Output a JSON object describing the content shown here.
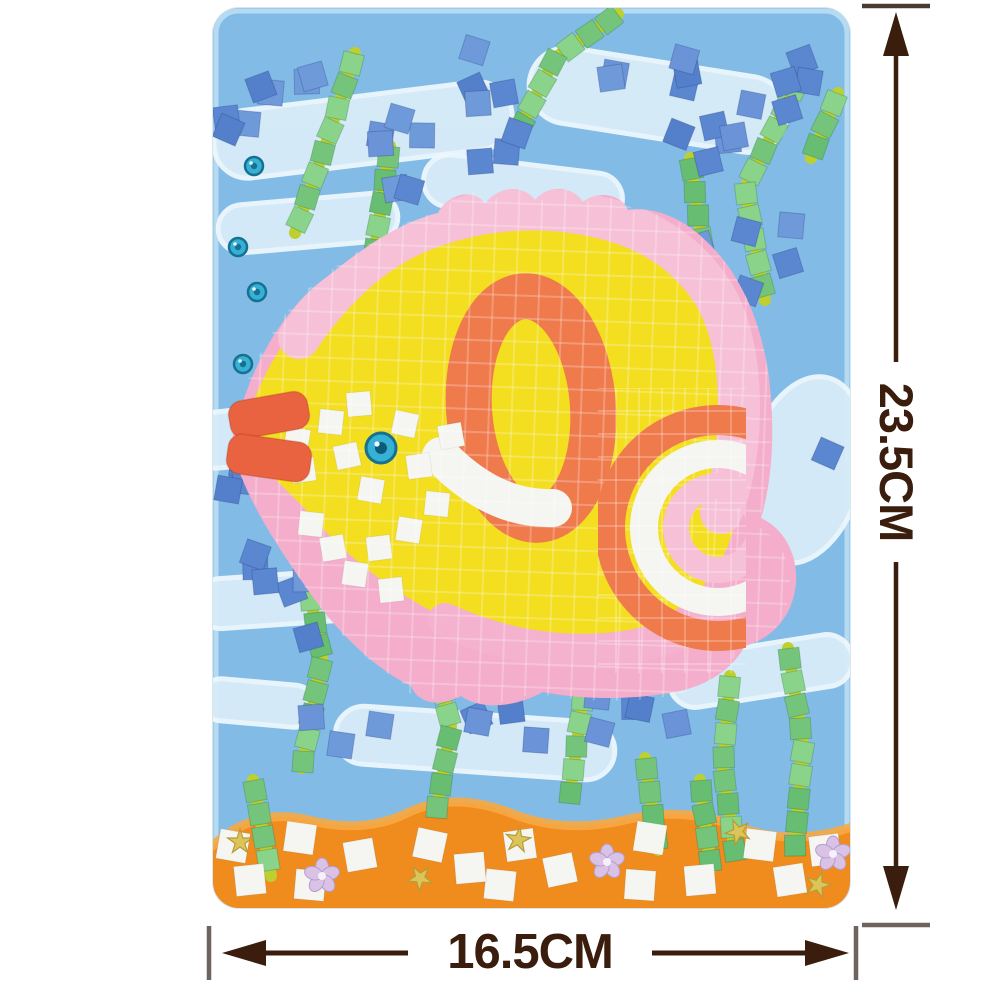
{
  "product": {
    "description": "Foam mosaic sticker craft kit picture of a tropical fish under water",
    "subject": "mosaic-fish-craft-board"
  },
  "dims": {
    "arrow_color": "#3a1d0d",
    "cap_color": "#6e645d",
    "height": {
      "label": "23.5CM",
      "x": 896,
      "cap_top_y": 6,
      "cap_bottom_y": 925,
      "tip_top": 12,
      "tip_bottom": 910,
      "gap_start": 362,
      "gap_end": 562,
      "cap_half": 34
    },
    "width": {
      "label": "16.5CM",
      "y": 953,
      "cap_left_x": 209,
      "cap_right_x": 856,
      "tip_left": 222,
      "tip_right": 849,
      "gap_start": 408,
      "gap_end": 652,
      "cap_half": 27
    }
  },
  "scene": {
    "board": {
      "bg": "#82bce6",
      "rim": "#d3e9f7"
    },
    "palette": {
      "wave": "#d8ecf8",
      "wave_edge": "#eef7fd",
      "blues": [
        "#5b86d0",
        "#6b94d8",
        "#5480cb",
        "#6e9ada"
      ],
      "greens": [
        "#74c57b",
        "#8ad38a",
        "#67bd72"
      ],
      "stem": "#bdd02f",
      "pink_base": "#f4aecb",
      "pink_tile": "#f6c0d7",
      "pink_tile2": "#f4b2cf",
      "yellow": "#f3de20",
      "orange": "#ef7a4c",
      "lip": "#ea6340",
      "white_tile": "#f5f6f2",
      "sand": "#f08c1e",
      "sand_hi": "#f7a843",
      "gem": "#36b0d4",
      "gem_ring": "#15718f",
      "gold": "#dcc558",
      "gold_edge": "#b79b39",
      "lilac": "#d9c2e6",
      "lilac_edge": "#b49ccd"
    },
    "waves": [
      [
        150,
        122,
        300,
        68,
        -7
      ],
      [
        445,
        92,
        260,
        76,
        9
      ],
      [
        95,
        215,
        180,
        48,
        -5
      ],
      [
        310,
        182,
        200,
        52,
        7
      ],
      [
        100,
        422,
        250,
        56,
        -6
      ],
      [
        352,
        520,
        250,
        64,
        11
      ],
      [
        88,
        590,
        210,
        50,
        -4
      ],
      [
        262,
        735,
        280,
        58,
        4
      ],
      [
        548,
        663,
        185,
        52,
        -9
      ],
      [
        592,
        462,
        115,
        190,
        14
      ],
      [
        45,
        695,
        115,
        42,
        5
      ]
    ],
    "gems": [
      [
        41,
        158
      ],
      [
        25,
        239
      ],
      [
        44,
        284
      ],
      [
        30,
        356
      ]
    ],
    "seaweed": [
      {
        "pts": [
          [
            142,
            45
          ],
          [
            115,
            130
          ],
          [
            82,
            225
          ]
        ]
      },
      {
        "pts": [
          [
            177,
            138
          ],
          [
            162,
            240
          ],
          [
            148,
            340
          ],
          [
            152,
            462
          ]
        ]
      },
      {
        "pts": [
          [
            405,
            6
          ],
          [
            342,
            50
          ],
          [
            302,
            130
          ]
        ]
      },
      {
        "pts": [
          [
            477,
            150
          ],
          [
            490,
            242
          ]
        ]
      },
      {
        "pts": [
          [
            587,
            70
          ],
          [
            532,
            180
          ],
          [
            552,
            292
          ]
        ]
      },
      {
        "pts": [
          [
            625,
            85
          ],
          [
            598,
            150
          ]
        ]
      },
      {
        "pts": [
          [
            87,
            535
          ],
          [
            109,
            650
          ],
          [
            89,
            760
          ]
        ]
      },
      {
        "pts": [
          [
            40,
            772
          ],
          [
            58,
            868
          ]
        ]
      },
      {
        "pts": [
          [
            215,
            628
          ],
          [
            238,
            718
          ],
          [
            224,
            800
          ]
        ]
      },
      {
        "pts": [
          [
            355,
            588
          ],
          [
            370,
            688
          ],
          [
            357,
            788
          ]
        ]
      },
      {
        "pts": [
          [
            517,
            668
          ],
          [
            510,
            760
          ],
          [
            522,
            845
          ]
        ]
      },
      {
        "pts": [
          [
            575,
            640
          ],
          [
            590,
            737
          ],
          [
            582,
            838
          ]
        ]
      },
      {
        "pts": [
          [
            432,
            750
          ],
          [
            445,
            842
          ]
        ]
      },
      {
        "pts": [
          [
            487,
            772
          ],
          [
            498,
            860
          ]
        ]
      }
    ],
    "bubbles": [
      {
        "x": 8,
        "y": 38,
        "w": 110,
        "h": 85,
        "n": 7
      },
      {
        "x": 125,
        "y": 105,
        "w": 200,
        "h": 95,
        "n": 9
      },
      {
        "x": 228,
        "y": 40,
        "w": 95,
        "h": 60,
        "n": 4
      },
      {
        "x": 355,
        "y": 18,
        "w": 120,
        "h": 85,
        "n": 5
      },
      {
        "x": 462,
        "y": 88,
        "w": 120,
        "h": 100,
        "n": 6
      },
      {
        "x": 552,
        "y": 28,
        "w": 75,
        "h": 75,
        "n": 4
      },
      {
        "x": 468,
        "y": 205,
        "w": 120,
        "h": 90,
        "n": 6
      },
      {
        "x": 5,
        "y": 425,
        "w": 115,
        "h": 95,
        "n": 6
      },
      {
        "x": 18,
        "y": 542,
        "w": 120,
        "h": 90,
        "n": 7
      },
      {
        "x": 135,
        "y": 562,
        "w": 110,
        "h": 75,
        "n": 5
      },
      {
        "x": 252,
        "y": 688,
        "w": 95,
        "h": 60,
        "n": 4
      },
      {
        "x": 372,
        "y": 682,
        "w": 115,
        "h": 55,
        "n": 5
      },
      {
        "x": 585,
        "y": 428,
        "w": 35,
        "h": 35,
        "n": 1
      },
      {
        "x": 95,
        "y": 700,
        "w": 80,
        "h": 45,
        "n": 3
      }
    ],
    "fish": {
      "base_d": "M 18 436 C 35 360 70 300 115 268 C 150 240 185 215 225 205 C 235 185 262 180 272 196 C 285 178 310 176 322 192 C 335 176 360 178 370 194 C 385 182 408 186 415 202 C 440 198 470 210 492 232 C 525 262 548 310 556 370 C 562 420 560 470 548 510 C 570 520 585 545 583 575 C 580 608 560 630 532 638 C 520 660 495 678 462 684 C 420 692 370 692 330 684 C 300 700 268 702 248 688 C 225 700 205 695 198 678 C 160 660 120 620 90 575 C 55 525 28 480 18 436 Z",
      "body_d": "M 26 436 C 45 368 78 312 122 282 C 170 248 225 226 280 222 C 345 216 410 228 458 260 C 498 288 522 335 530 390 C 536 445 530 500 514 540 C 494 585 455 615 405 628 C 355 640 300 636 252 618 C 200 598 145 560 105 515 C 68 474 40 452 26 436 Z",
      "ring": {
        "cx": 318,
        "cy": 400,
        "rx": 62,
        "ry": 112,
        "w": 46,
        "rot": -4
      },
      "white_band_d": "M 228 448 Q 280 502 340 500",
      "top_band_d": "M 86 330 Q 140 250 210 222 Q 300 188 390 210 Q 465 228 502 288 Q 526 330 526 400 Q 526 458 508 505",
      "bottom_band_d": "M 232 612 Q 320 652 410 640 Q 462 632 500 608",
      "fins": [
        "M 222 588 C 212 628 212 650 220 672 C 232 650 244 620 248 594 Z",
        "M 250 600 C 246 636 250 658 258 676 C 268 652 274 624 276 602 Z"
      ],
      "tail": {
        "cx": 505,
        "cy": 520,
        "clip": [
          385,
          380,
          148,
          285
        ],
        "arcs": [
          {
            "r": 108,
            "w": 30,
            "c": "orange"
          },
          {
            "r": 74,
            "w": 28,
            "c": "white_tile"
          },
          {
            "r": 42,
            "w": 26,
            "c": "pink_tile"
          }
        ]
      },
      "lips": [
        {
          "x": 16,
          "y": 388,
          "w": 80,
          "h": 38,
          "rot": -10
        },
        {
          "x": 14,
          "y": 430,
          "w": 84,
          "h": 40,
          "rot": 8
        }
      ],
      "eye": {
        "x": 168,
        "y": 440,
        "r": 15
      },
      "face_tiles": [
        [
          84,
          432,
          10
        ],
        [
          90,
          462,
          -8
        ],
        [
          118,
          414,
          6
        ],
        [
          134,
          448,
          -12
        ],
        [
          158,
          482,
          10
        ],
        [
          146,
          396,
          -5
        ],
        [
          192,
          416,
          12
        ],
        [
          206,
          458,
          -8
        ],
        [
          224,
          496,
          6
        ],
        [
          238,
          428,
          -10
        ],
        [
          196,
          522,
          9
        ],
        [
          166,
          540,
          -7
        ],
        [
          120,
          540,
          -10
        ],
        [
          98,
          516,
          6
        ],
        [
          142,
          566,
          8
        ],
        [
          178,
          582,
          -6
        ]
      ],
      "grout": {
        "size": 23,
        "color": "rgba(255,255,255,0.24)"
      }
    },
    "sand": {
      "d": "M -5 842 Q 40 798 95 812 Q 150 826 192 806 Q 240 782 300 806 Q 352 826 412 812 Q 470 798 522 818 Q 580 840 642 818 L 642 905 L -5 905 Z",
      "hi_d": "M -5 842 Q 40 798 95 812 Q 150 826 192 806 Q 240 782 300 806 Q 352 826 412 812 Q 470 798 522 818 Q 580 840 642 818",
      "tiles": [
        [
          87,
          830,
          8
        ],
        [
          147,
          847,
          -10
        ],
        [
          97,
          877,
          5
        ],
        [
          37,
          872,
          -6
        ],
        [
          217,
          837,
          12
        ],
        [
          307,
          837,
          -8
        ],
        [
          287,
          877,
          6
        ],
        [
          347,
          862,
          -12
        ],
        [
          437,
          830,
          9
        ],
        [
          487,
          872,
          -5
        ],
        [
          547,
          837,
          7
        ],
        [
          577,
          872,
          -9
        ],
        [
          427,
          877,
          4
        ],
        [
          612,
          842,
          -7
        ],
        [
          20,
          838,
          10
        ],
        [
          257,
          860,
          -5
        ]
      ],
      "stars": [
        [
          27,
          834
        ],
        [
          207,
          870
        ],
        [
          305,
          832
        ],
        [
          525,
          824
        ],
        [
          605,
          877
        ]
      ],
      "flowers": [
        [
          109,
          868
        ],
        [
          394,
          854
        ],
        [
          620,
          846
        ]
      ]
    }
  }
}
